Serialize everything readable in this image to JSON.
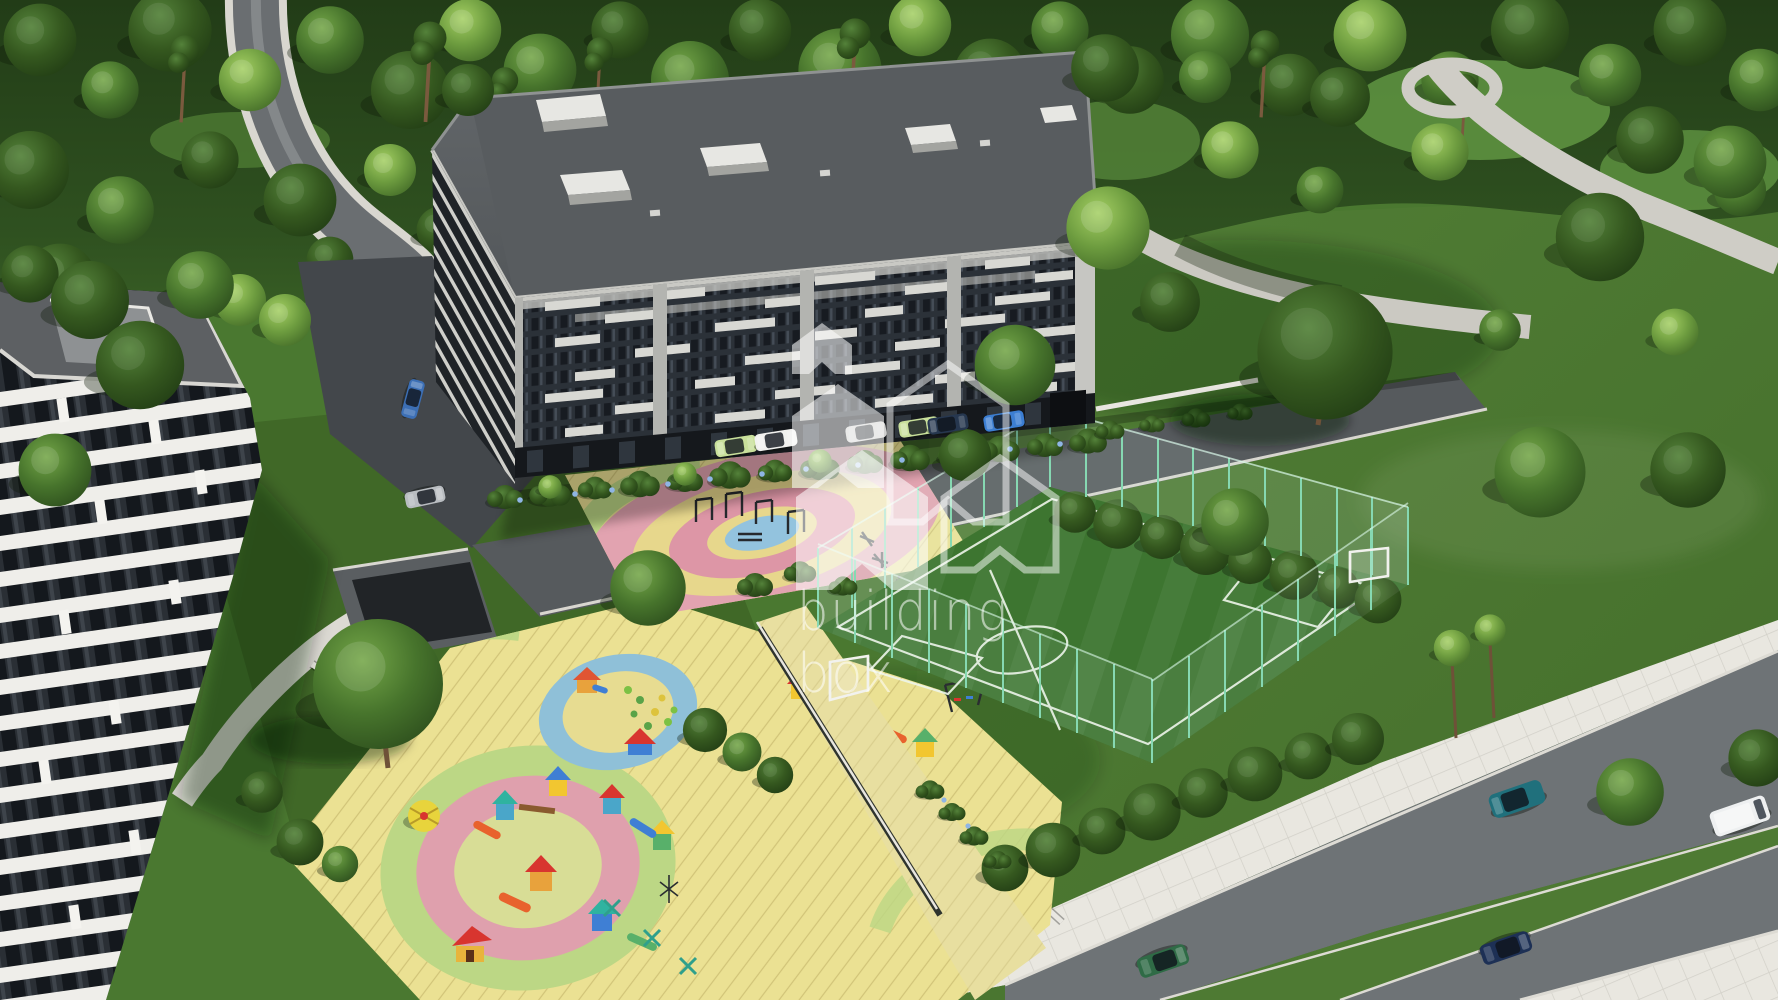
{
  "watermark": {
    "brand_line1": "building",
    "brand_line2": "box",
    "logo": "houses-cluster-icon",
    "color": "#ffffff"
  },
  "scene_title": "aerial 3d render of a residential complex with playgrounds and sports field",
  "palette": {
    "lawn": "#4a7830",
    "lawn_dark": "#3c6123",
    "forest": "#2a471d",
    "asphalt": "#6e7376",
    "street": "#565a5d",
    "intersection": "#43474b",
    "sidewalk": "#e9e7e0",
    "pavement_yellow": "#ebe193",
    "walkway_tan": "#e8dfa0",
    "wall_white": "#e9e7e1"
  },
  "main_building": {
    "facade": "#30363d",
    "panel": "#d8d8d3",
    "pilaster": "#b3b4b0",
    "roof": "#5e6265",
    "window": "#171b21",
    "ground_floor": "#15181c"
  },
  "white_building": {
    "band": "#efeeea",
    "window": "#14181d",
    "roof": "#5d6063",
    "roof_box": "#8e9193"
  },
  "fitness_area": {
    "rings": [
      "#e2a3b0",
      "#e7d78c",
      "#dd96a6",
      "#e7d78c",
      "#93c3de"
    ],
    "equipment": "#26292d"
  },
  "kids_area": {
    "circle_small": [
      "#8fc0d8",
      "#e7dc91"
    ],
    "circle_large": [
      "#bcd785",
      "#dfa0ad",
      "#d8dd96"
    ],
    "equipment_colors": [
      "#d8352f",
      "#3f7fd4",
      "#2fb3a0",
      "#f2c630",
      "#58b06a",
      "#e8622d",
      "#e8d43c"
    ]
  },
  "field": {
    "turf": "#3d7530",
    "turf_stripe": "#ffffff",
    "line": "#eef5ea",
    "fence": "#86d8b2"
  },
  "vehicles": [
    {
      "id": "car-parked-1",
      "role": "parked",
      "color_name": "light-green",
      "hex": "#c9e09b"
    },
    {
      "id": "car-parked-2",
      "role": "parked",
      "color_name": "white",
      "hex": "#f1f1ef"
    },
    {
      "id": "car-parked-3",
      "role": "parked",
      "color_name": "white",
      "hex": "#f1f1ef"
    },
    {
      "id": "car-parked-4",
      "role": "parked",
      "color_name": "light-green",
      "hex": "#c9e09b"
    },
    {
      "id": "car-parked-5",
      "role": "parked",
      "color_name": "navy",
      "hex": "#26374f"
    },
    {
      "id": "car-parked-6",
      "role": "parked",
      "color_name": "blue",
      "hex": "#3c7ed2"
    },
    {
      "id": "car-intersection",
      "role": "driving",
      "color_name": "blue",
      "hex": "#3c6fb5"
    },
    {
      "id": "car-street-silver",
      "role": "driving",
      "color_name": "silver",
      "hex": "#b9bdc1"
    },
    {
      "id": "car-boulevard-green",
      "role": "driving",
      "color_name": "dark-green",
      "hex": "#2f6b46"
    },
    {
      "id": "suv-boulevard-teal",
      "role": "driving",
      "color_name": "teal",
      "hex": "#20707c"
    },
    {
      "id": "van-boulevard-white",
      "role": "driving",
      "color_name": "white",
      "hex": "#eef0f1"
    },
    {
      "id": "car-boulevard-navy",
      "role": "driving",
      "color_name": "navy",
      "hex": "#1d3055"
    }
  ],
  "vegetation": {
    "tree_mid": "#47742c",
    "tree_dark": "#2c4b1d",
    "tree_light": "#5d8c38",
    "bush": "#2f4d22",
    "flowers": "#8fb5e4"
  }
}
